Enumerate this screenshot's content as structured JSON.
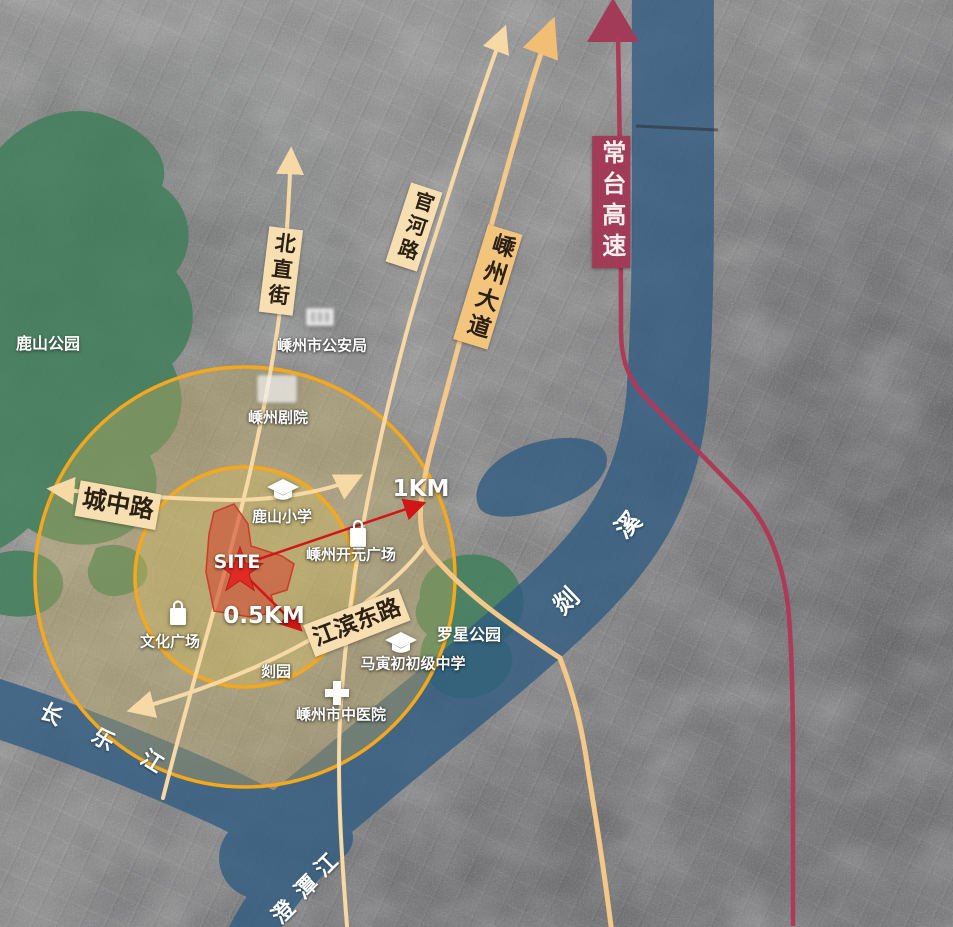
{
  "map": {
    "site_label": "SITE",
    "radius_labels": {
      "inner": "0.5KM",
      "outer": "1KM"
    }
  },
  "road_labels": {
    "beizhijie": "北直街",
    "guanhelu": "官河路",
    "shengzhoudadao": "嵊州大道",
    "chengzhonglu": "城中路",
    "jiangbindonglu": "江滨东路"
  },
  "expressway_label": "常台高速",
  "river_labels": {
    "shanxi": {
      "char1": "剡",
      "char2": "溪"
    },
    "changlejiang": {
      "char1": "长",
      "char2": "乐",
      "char3": "江"
    },
    "chengtanjiang": {
      "char1": "澄",
      "char2": "潭",
      "char3": "江"
    }
  },
  "park_labels": {
    "lushan": "鹿山公园",
    "luoxing": "罗星公园"
  },
  "poi_labels": {
    "police": "嵊州市公安局",
    "theater": "嵊州剧院",
    "primary_school": "鹿山小学",
    "kaiyuan_plaza": "嵊州开元广场",
    "culture_plaza": "文化广场",
    "shan_garden": "剡园",
    "junior_high": "马寅初初级中学",
    "tcm_hospital": "嵊州市中医院"
  },
  "icons": {
    "site_marker": "star-icon",
    "schools": "graduation-cap-icon",
    "hospital": "hospital-cross-icon",
    "culture_plaza": "shopping-bag-icon",
    "kaiyuan_plaza": "mall-bag-icon",
    "police": "building-icon",
    "theater": "building-icon",
    "north_arrows": "road-arrow-icon"
  },
  "colors": {
    "road_cream": "#F6D9A4",
    "avenue_amber": "#F2BE74",
    "ring_orange": "#F5A81C",
    "river_blue": "#2F5B82",
    "park_green": "#3E7E5A",
    "expressway_maroon": "#A23B58",
    "site_red": "#E02A24",
    "measure_red": "#D01616",
    "label_bg_cream": "#F7DFB2"
  }
}
